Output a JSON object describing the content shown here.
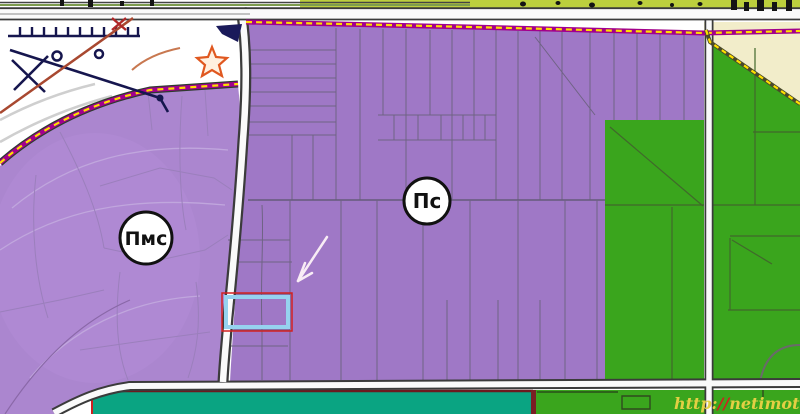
{
  "map": {
    "zone_labels": [
      {
        "id": "pmc",
        "label": "Пмс"
      },
      {
        "id": "ps",
        "label": "Пс"
      }
    ],
    "watermark": {
      "full": "http://netimoti.net",
      "protocol": "http:",
      "slashes": "//",
      "domain": "netimoti.net"
    },
    "colors": {
      "zone_left": "#ab86cf",
      "zone_main": "#9f78c6",
      "zone_green": "#3aa51d",
      "zone_teal": "#0aa482",
      "zone_cream": "#f2edca",
      "strip_yellow_green": "#bccf3d",
      "boundary_magenta": "#a2008c",
      "boundary_yellow": "#ffdf00",
      "road_fill": "#fafafa",
      "road_casing": "#3b3b3b",
      "highlight_blue": "#96d2ef",
      "outline_red": "#d32020",
      "arrow_white": "#f8ecf5",
      "watermark_yellow": "#e3cf43",
      "watermark_red": "#cf2020"
    }
  }
}
